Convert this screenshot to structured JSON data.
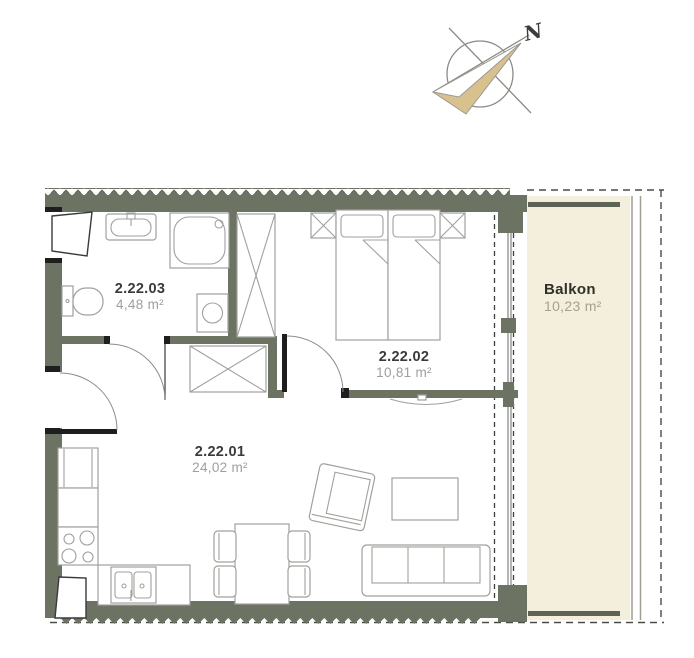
{
  "compass": {
    "north_label": "N"
  },
  "rooms": [
    {
      "id": "2.22.03",
      "area": "4,48 m²"
    },
    {
      "id": "2.22.02",
      "area": "10,81 m²"
    },
    {
      "id": "2.22.01",
      "area": "24,02 m²"
    }
  ],
  "balcony": {
    "name": "Balkon",
    "area": "10,23 m²"
  },
  "colors": {
    "wall": "#6d7363",
    "balcony_fill": "#f3efdc",
    "balcony_rail": "#5e6455",
    "compass_arrow": "#d9c08f",
    "room_number_text": "#3a3a3a",
    "room_area_text": "#9e9e9e",
    "furniture_line": "#a0a09c",
    "door_black": "#1e1e1e",
    "dash_line": "#4c4c45"
  }
}
